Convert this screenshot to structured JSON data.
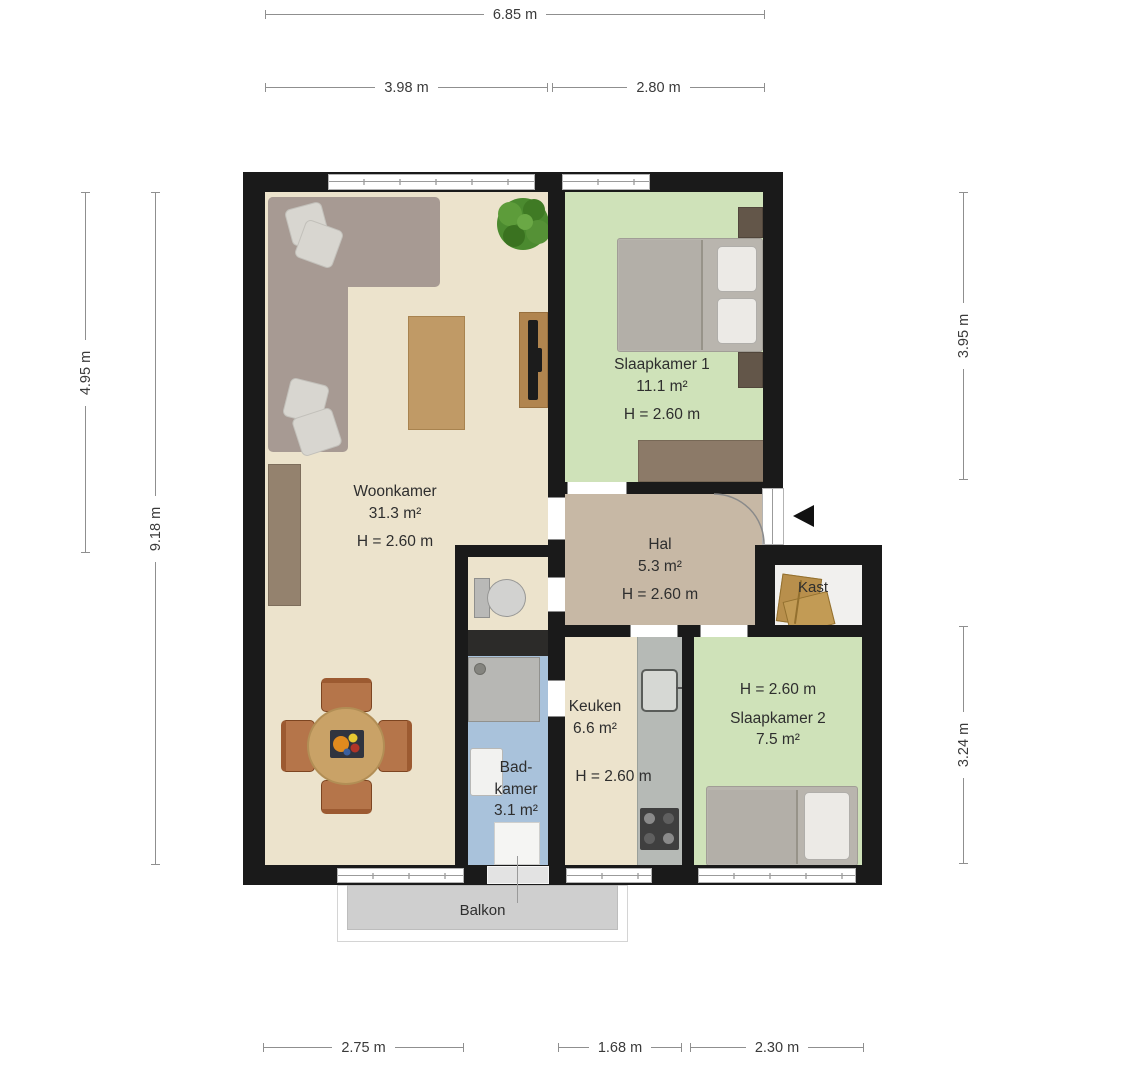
{
  "plan_type": "floorplan",
  "dims": {
    "top_total": "6.85 m",
    "top_left": "3.98 m",
    "top_right": "2.80 m",
    "left_inner": "4.95 m",
    "left_outer": "9.18 m",
    "right_top": "3.95 m",
    "right_bottom": "3.24 m",
    "bottom_left": "2.75 m",
    "bottom_mid": "1.68 m",
    "bottom_right": "2.30 m"
  },
  "rooms": {
    "woonkamer": {
      "name": "Woonkamer",
      "area": "31.3 m²",
      "height": "H = 2.60 m"
    },
    "slaapkamer1": {
      "name": "Slaapkamer 1",
      "area": "11.1 m²",
      "height": "H = 2.60 m"
    },
    "hal": {
      "name": "Hal",
      "area": "5.3 m²",
      "height": "H = 2.60 m"
    },
    "keuken": {
      "name": "Keuken",
      "area": "6.6 m²",
      "height": "H = 2.60 m"
    },
    "badkamer": {
      "name_line1": "Bad-",
      "name_line2": "kamer",
      "area": "3.1 m²"
    },
    "slaapkamer2": {
      "name": "Slaapkamer 2",
      "area": "7.5 m²",
      "height": "H = 2.60 m"
    },
    "kast": {
      "name": "Kast"
    },
    "balkon": {
      "name": "Balkon"
    }
  },
  "icons": {
    "entrance_arrow": "left-pointing-triangle",
    "woonkamer": [
      "corner-sofa",
      "pillows",
      "plant",
      "coffee-table",
      "tv-sideboard",
      "sideboard",
      "dining-table",
      "dining-chairs",
      "fruit-bowl"
    ],
    "slaapkamer1": [
      "double-bed",
      "nightstands",
      "dresser"
    ],
    "slaapkamer2": [
      "single-bed"
    ],
    "badkamer": [
      "shower",
      "washbasin",
      "shower-mat"
    ],
    "wc": [
      "toilet"
    ],
    "keuken": [
      "kitchen-counter",
      "sink",
      "stove"
    ],
    "kast": [
      "storage-boxes"
    ]
  },
  "colors": {
    "wall": "#1a1a1a",
    "floor_living": "#ece3cc",
    "floor_bedroom": "#cfe2b9",
    "floor_hall": "#c7b8a5",
    "floor_bath": "#a9c2db",
    "floor_closet": "#f1f0ee",
    "balcony": "#cfcfcf",
    "dimension_line": "#8f8f8f",
    "text": "#2e2e2e"
  }
}
